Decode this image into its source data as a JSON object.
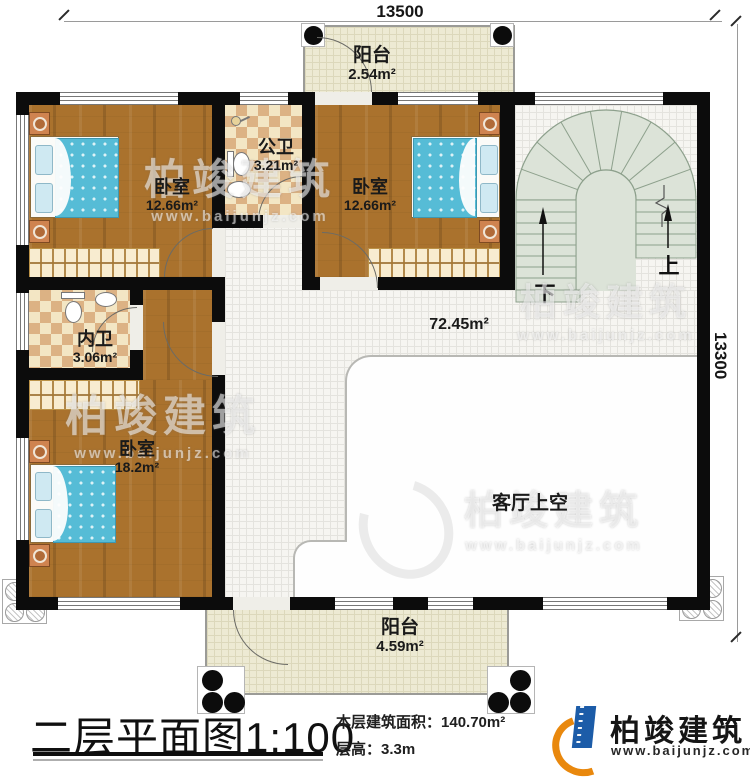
{
  "dimensions": {
    "top": "13500",
    "right": "13300"
  },
  "rooms": [
    {
      "name": "阳台",
      "area": "2.54m²"
    },
    {
      "name": "卧室",
      "area": "12.66m²"
    },
    {
      "name": "公卫",
      "area": "3.21m²"
    },
    {
      "name": "卧室",
      "area": "12.66m²"
    },
    {
      "name": "内卫",
      "area": "3.06m²"
    },
    {
      "name": "卧室",
      "area": "18.2m²"
    },
    {
      "name": "客厅上空",
      "area": ""
    },
    {
      "name": "阳台",
      "area": "4.59m²"
    }
  ],
  "hall": {
    "area": "72.45m²"
  },
  "stairs": {
    "up_label": "上",
    "down_label": "下"
  },
  "footer": {
    "title": "二层平面图",
    "scale": "1:100",
    "area_label": "本层建筑面积：",
    "area_value": "140.70m²",
    "height_label": "层高：",
    "height_value": "3.3m"
  },
  "brand": {
    "name": "柏竣建筑",
    "site": "www.baijunjz.com"
  },
  "watermark": {
    "name": "柏竣建筑",
    "site": "www.baijunjz.com"
  }
}
